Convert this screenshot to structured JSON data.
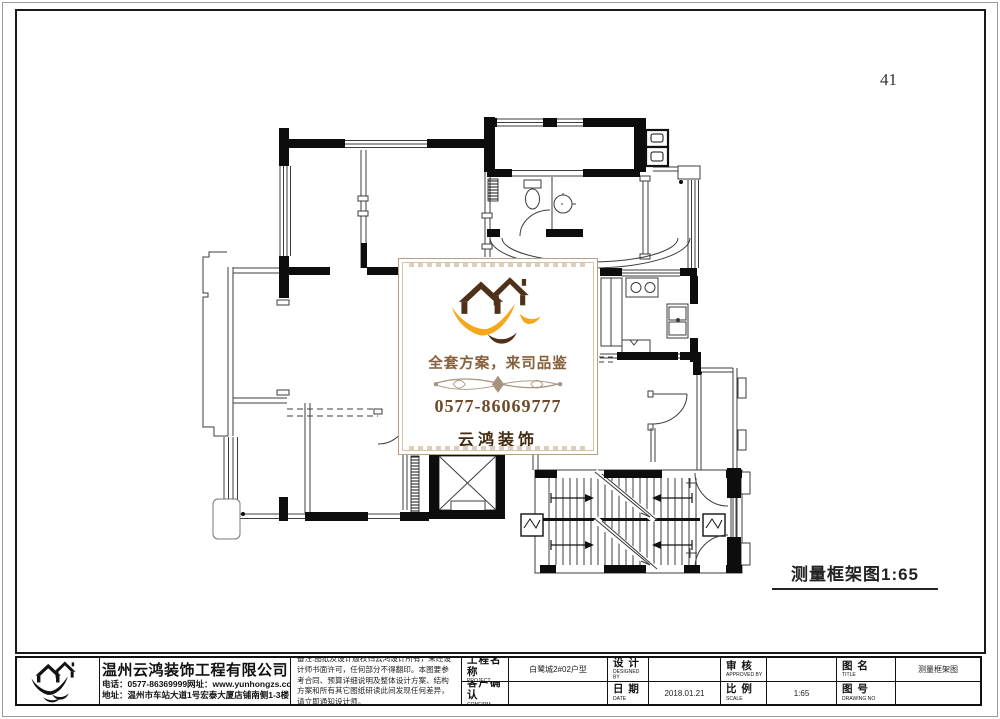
{
  "page": {
    "number": "41"
  },
  "drawing_label": {
    "text": "测量框架图1:65"
  },
  "watermark": {
    "slogan": "全套方案，来司品鉴",
    "phone": "0577-86069777",
    "brand": "云鸿装饰",
    "colors": {
      "roof": "#4f3018",
      "swoosh": "#f6a81c",
      "slogan": "#86603a",
      "phone": "#6f4a28",
      "brand": "#43290f"
    }
  },
  "title_block": {
    "company": {
      "name": "温州云鸿装饰工程有限公司",
      "phone_line": "电话：0577-86369999网址：www.yunhongzs.com",
      "address_line": "地址：温州市车站大道1号宏泰大厦店铺南侧1-3楼"
    },
    "notes": "备注:图纸及设计版权归云鸿设计所有，未经设计师书面许可，任何部分不得翻印。本图要参考合同、预算详细说明及整体设计方案、结构方案和所有其它图纸研读此间发现任何差异，请立即通知设计师。",
    "fields": [
      {
        "label": "工程名称",
        "sub": "PROJECT",
        "value": "白鹭城2#02户型"
      },
      {
        "label": "设  计",
        "sub": "DESIGNED BY",
        "value": ""
      },
      {
        "label": "审  核",
        "sub": "APPROVED BY",
        "value": ""
      },
      {
        "label": "图  名",
        "sub": "TITLE",
        "value": "测量框架图"
      },
      {
        "label": "客户确认",
        "sub": "CONFIRM",
        "value": ""
      },
      {
        "label": "日  期",
        "sub": "DATE",
        "value": "2018.01.21"
      },
      {
        "label": "比  例",
        "sub": "SCALE",
        "value": "1:65"
      },
      {
        "label": "图  号",
        "sub": "DRAWING NO",
        "value": ""
      }
    ]
  }
}
